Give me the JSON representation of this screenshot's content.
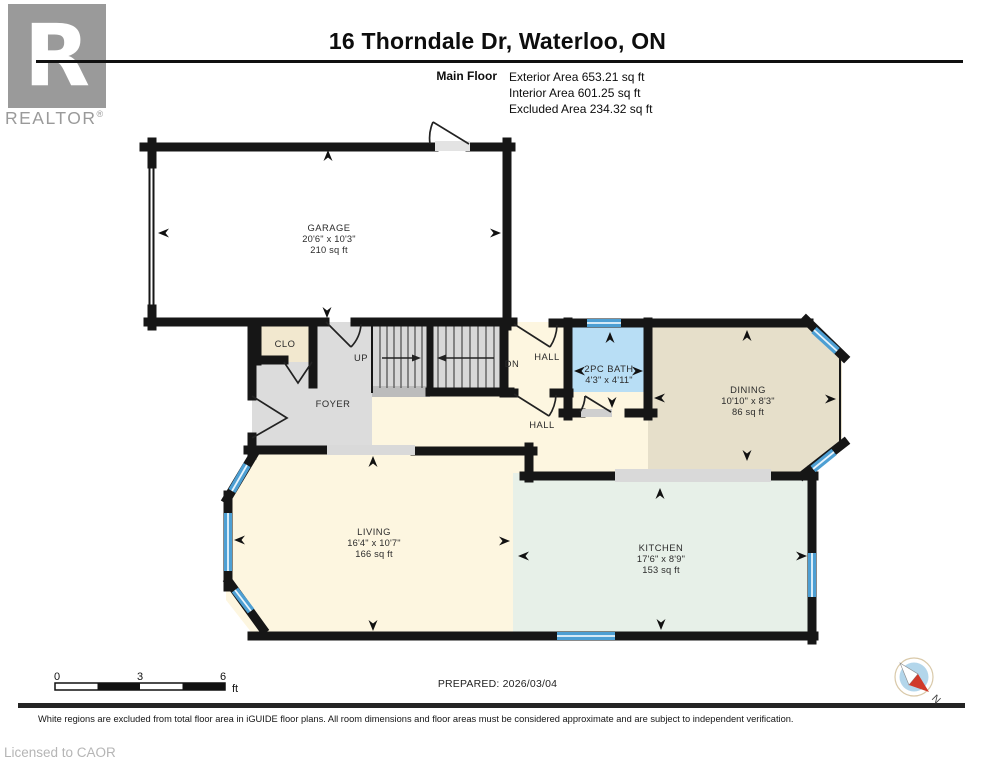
{
  "header": {
    "title": "16 Thorndale Dr, Waterloo, ON",
    "floor_label": "Main Floor",
    "stats": [
      "Exterior Area 653.21 sq ft",
      "Interior Area 601.25 sq ft",
      "Excluded Area 234.32 sq ft"
    ]
  },
  "branding": {
    "logo_letter": "R",
    "logo_text": "REALTOR",
    "logo_reg": "®",
    "licensed_to": "Licensed to CAOR"
  },
  "rooms": {
    "garage": {
      "name": "GARAGE",
      "dims": "20'6\" x 10'3\"",
      "area": "210 sq ft"
    },
    "closet": {
      "name": "CLO"
    },
    "foyer": {
      "name": "FOYER"
    },
    "stairs_up": {
      "label": "UP"
    },
    "stairs_down": {
      "label": "DN"
    },
    "hall_upper": {
      "name": "HALL"
    },
    "hall_lower": {
      "name": "HALL"
    },
    "bath": {
      "name": "2PC BATH",
      "dims": "4'3\" x 4'11\""
    },
    "dining": {
      "name": "DINING",
      "dims": "10'10\" x 8'3\"",
      "area": "86 sq ft"
    },
    "living": {
      "name": "LIVING",
      "dims": "16'4\" x 10'7\"",
      "area": "166 sq ft"
    },
    "kitchen": {
      "name": "KITCHEN",
      "dims": "17'6\" x 8'9\"",
      "area": "153 sq ft"
    }
  },
  "scale_bar": {
    "tick0": "0",
    "tick1": "3",
    "tick2": "6",
    "unit": "ft"
  },
  "footer": {
    "prepared": "PREPARED: 2026/03/04",
    "disclaimer": "White regions are excluded from total floor area in iGUIDE floor plans. All room dimensions and floor areas must be considered approximate and are subject to independent verification.",
    "compass_north": "N"
  },
  "colors": {
    "wall": "#161616",
    "floor_cream": "#fdf6e0",
    "floor_grey": "#dcdcdc",
    "floor_tan": "#e6dfca",
    "floor_mint": "#e7f0e8",
    "floor_blue": "#b8def5",
    "floor_beige": "#f2e8cf",
    "window_blue": "#4d9fd3",
    "logo_grey": "#9a9a9a"
  }
}
